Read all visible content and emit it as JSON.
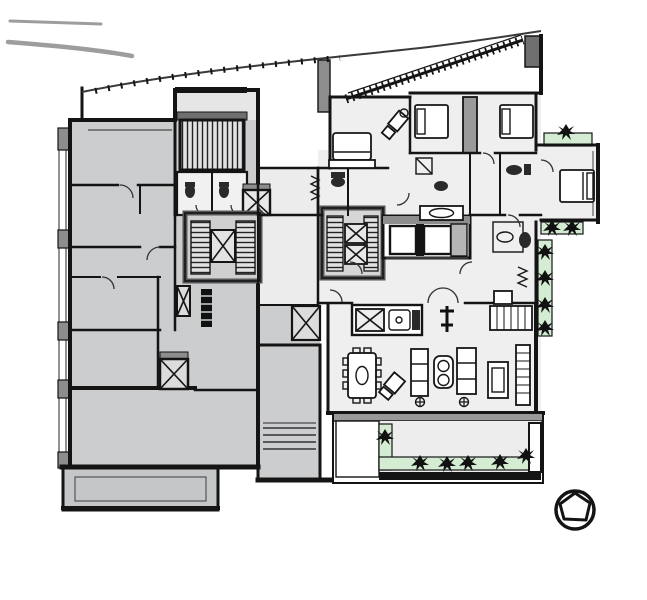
{
  "figure": {
    "kind": "architectural-floor-plan",
    "description": "Black-and-white residential tower floor plan with two apartment units, central elevator and stair cores, furnished right unit, shaded left unit, terraces with green planters, and a tree symbol at lower right",
    "visible_text": []
  },
  "palette": {
    "background": "#ffffff",
    "wall": "#141414",
    "wall-soft": "#555555",
    "unit-left": "#cbcdce",
    "unit-right": "#efefef",
    "core": "#d6d6d6",
    "stair-fill": "#e2e2e2",
    "mid-gray": "#8d8d8d",
    "dark-gray": "#6f6f6f",
    "green": "#d3ecd2",
    "floor-light": "#ededed",
    "fixture": "#2a2a2a",
    "line-gray": "#9d9d9d"
  },
  "legend_symbols": [
    {
      "name": "stair-run",
      "meaning": "hatched tread lines"
    },
    {
      "name": "elevator-shaft",
      "meaning": "rectangle crossed with X"
    },
    {
      "name": "door-swing",
      "meaning": "quarter-circle arc"
    },
    {
      "name": "bed",
      "meaning": "rectangle with pillow band"
    },
    {
      "name": "sofa",
      "meaning": "divided rectangle"
    },
    {
      "name": "dining-table",
      "meaning": "rounded rectangle with oval and chairs"
    },
    {
      "name": "planter",
      "meaning": "green strip with spiky plant blobs"
    },
    {
      "name": "tree-symbol",
      "meaning": "circle with inner pentagon"
    },
    {
      "name": "facade-louver",
      "meaning": "diagonal tick-hatched band"
    }
  ],
  "counts": {
    "beds": 4,
    "elevator-x-shafts": 8,
    "stair-cores": 3,
    "elevator-cars": 2,
    "terraces": 2
  }
}
